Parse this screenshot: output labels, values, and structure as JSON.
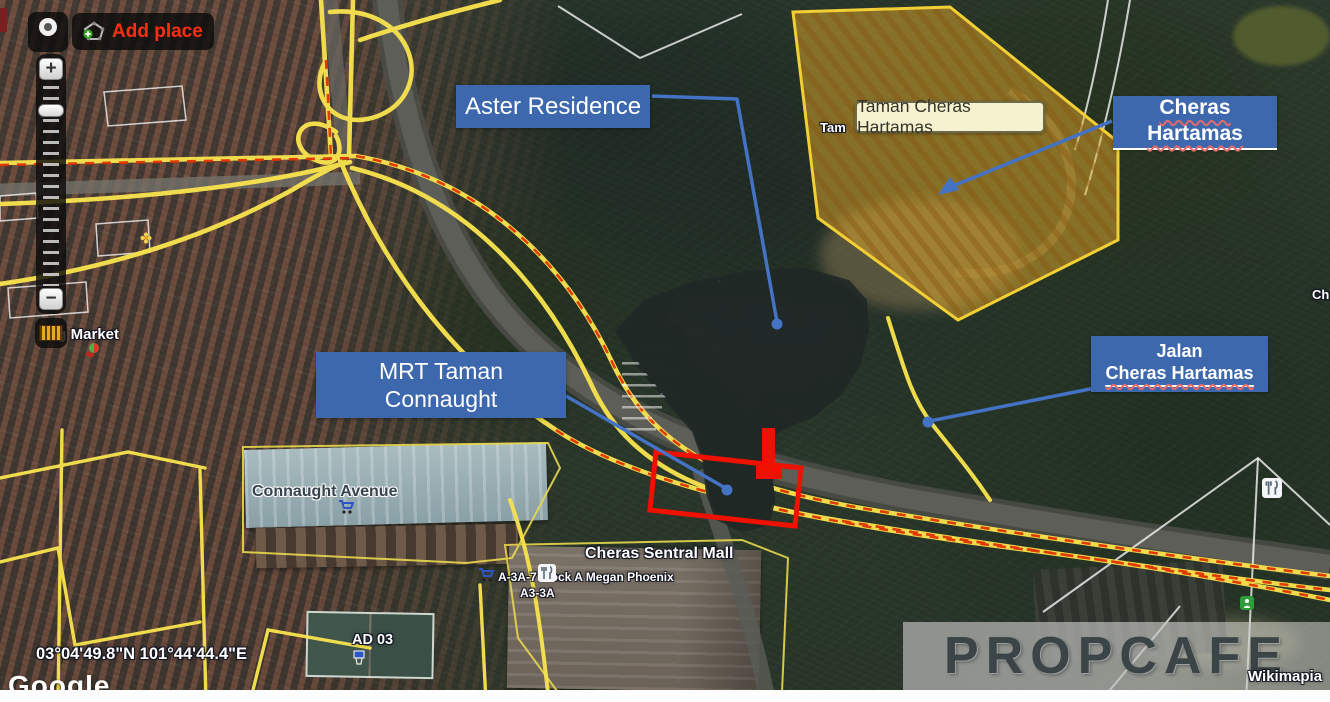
{
  "controls": {
    "add_place": "Add place",
    "zoom_in": "+",
    "zoom_out": "−"
  },
  "callouts": {
    "aster_residence": "Aster Residence",
    "taman_cheras_hartamas": "Taman Cheras Hartamas",
    "cheras_hartamas": "Cheras Hartamas",
    "mrt_line1": "MRT Taman",
    "mrt_line2": "Connaught",
    "jalan_line1": "Jalan",
    "jalan_line2": "Cheras Hartamas"
  },
  "map_labels": {
    "market": "ing Market",
    "connaught_avenue": "Connaught Avenue",
    "cheras_sentral_mall": "Cheras Sentral Mall",
    "megan_phoenix": "A-3A-7 block A Megan Phoenix",
    "block_a3": "A3-3A",
    "court": "AD 03",
    "edge_label": "Ch",
    "polygon_ghost": "Tam",
    "coordinates": "03°04'49.8\"N 101°44'44.4\"E",
    "google_logo": "Google",
    "wikimapia_credit": "Wikimapia",
    "watermark": "PROPCAFE"
  },
  "colors": {
    "callout_blue": "#3d68ae",
    "connector_blue": "#4472c4",
    "callout_cream": "#f6f2cf",
    "road_yellow": "#f7e24e",
    "traffic_dash_red": "#e03200",
    "highlight_polygon_fill": "#e0a92c",
    "highlight_polygon_border": "#f2cf35",
    "marker_red": "#ee1100",
    "add_place_red": "#ff2d12"
  }
}
